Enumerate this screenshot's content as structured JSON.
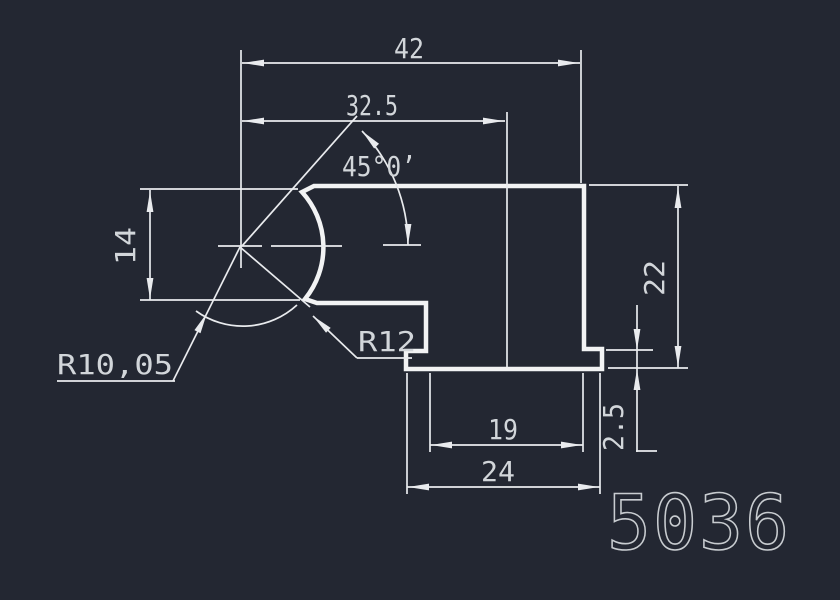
{
  "drawing": {
    "part_number": "5036",
    "colors": {
      "background": "#232732",
      "line": "#f2f3f4",
      "dim_line": "#e9ebee",
      "text": "#d2d6da",
      "part_number_color": "#c8ccd0"
    },
    "dimensions": {
      "total_width": "42",
      "upper_width": "32.5",
      "chamfer_angle": "45°0’",
      "left_height": "14",
      "right_height": "22",
      "groove_radius": "R10,05",
      "fillet_radius": "R12",
      "slot_width": "19",
      "base_width": "24",
      "step_height": "2.5"
    }
  }
}
